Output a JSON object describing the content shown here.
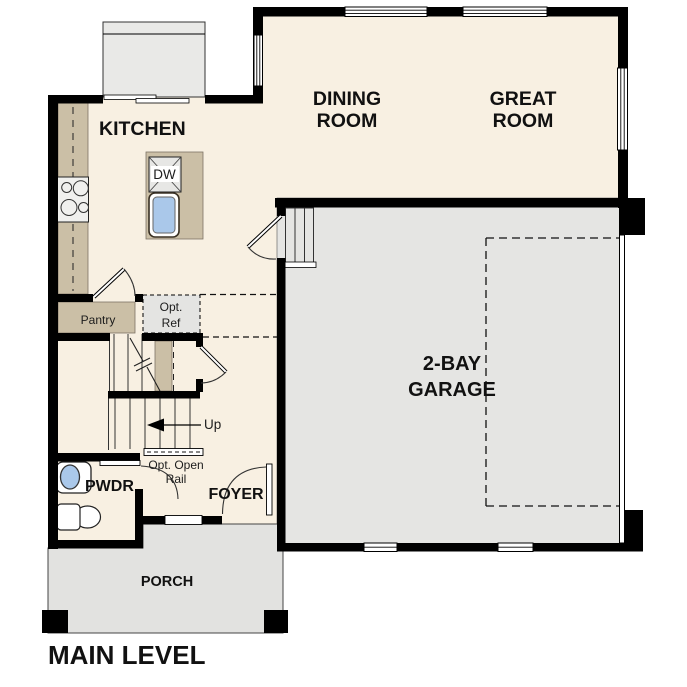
{
  "title": "MAIN LEVEL",
  "colors": {
    "floor": "#f8f0e2",
    "casework_tan": "#cbbfa6",
    "garage_floor": "#e5e5e3",
    "porch_floor": "#e2e2e0",
    "fixture_blue": "#aac8ea",
    "wall": "#000000"
  },
  "rooms": {
    "kitchen": {
      "label": "KITCHEN"
    },
    "dining_room": {
      "line1": "DINING",
      "line2": "ROOM"
    },
    "great_room": {
      "line1": "GREAT",
      "line2": "ROOM"
    },
    "garage": {
      "line1": "2-BAY",
      "line2": "GARAGE"
    },
    "pantry": {
      "label": "Pantry"
    },
    "powder_room": {
      "label": "PWDR"
    },
    "foyer": {
      "label": "FOYER"
    },
    "porch": {
      "label": "PORCH"
    }
  },
  "annotations": {
    "dishwasher": "DW",
    "optional_refrigerator": {
      "line1": "Opt.",
      "line2": "Ref"
    },
    "stair_direction": "Up",
    "optional_open_rail": {
      "line1": "Opt. Open",
      "line2": "Rail"
    }
  }
}
